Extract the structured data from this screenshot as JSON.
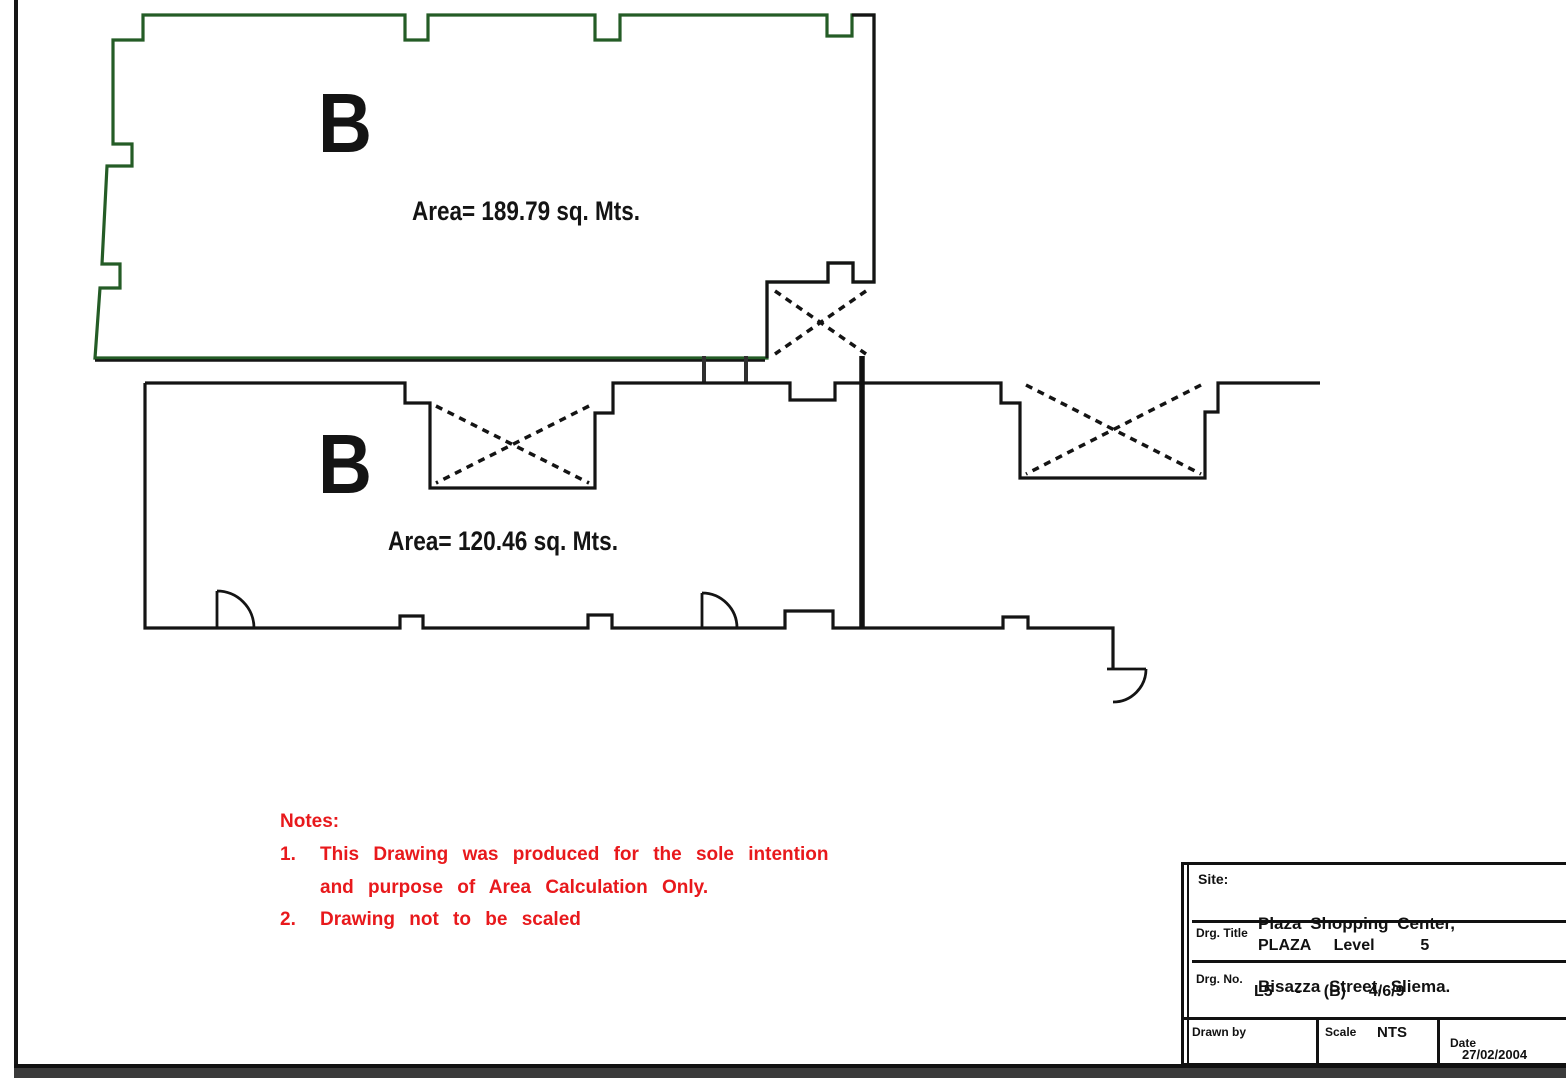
{
  "colors": {
    "line_black": "#141414",
    "unit_green": "#245c26",
    "note_red": "#e8191c",
    "footer_bar": "#3b3b3b"
  },
  "units": {
    "upper": {
      "label": "B",
      "area": "Area= 189.79 sq. Mts."
    },
    "lower": {
      "label": "B",
      "area": "Area= 120.46 sq. Mts."
    }
  },
  "notes": {
    "heading": "Notes:",
    "item1_num": "1.",
    "item1_line1": "This Drawing was produced for the sole intention",
    "item1_line2": "and purpose of Area Calculation Only.",
    "item2_num": "2.",
    "item2_line1": "Drawing not to be scaled"
  },
  "title_block": {
    "site_label": "Site:",
    "site_line1": "Plaza Shopping Center,",
    "site_line2": "Bisazza Street, Sliema.",
    "drg_title_label": "Drg. Title",
    "drg_title_value": "PLAZA  Level    5",
    "drg_no_label": "Drg. No.",
    "drg_no_value": "L5  -  (B)  4/6/9",
    "drawn_by_label": "Drawn by",
    "scale_label": "Scale",
    "scale_value": "NTS",
    "date_label": "Date",
    "date_value": "27/02/2004"
  }
}
